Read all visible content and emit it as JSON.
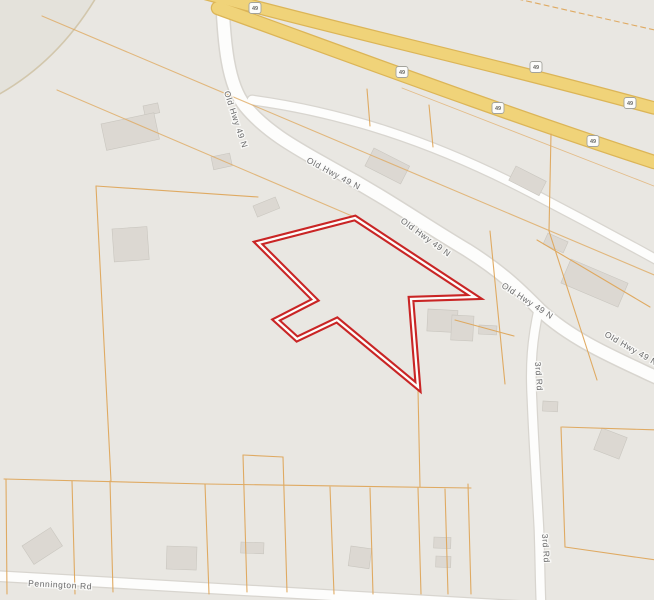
{
  "map": {
    "road_labels": {
      "old_hwy": "Old Hwy 49 N",
      "third_rd": "3rd Rd",
      "pennington": "Pennington Rd"
    },
    "highway": {
      "shield_number": "49"
    },
    "colors": {
      "background": "#e9e7e2",
      "corner_region": "#e4e2db",
      "highway_fill": "#f0d379",
      "highway_casing": "#dcb557",
      "road_fill": "#fdfdfc",
      "road_casing": "#d8d5cf",
      "parcel_line": "#dfa75c",
      "contour_line": "#cfc3a6",
      "building_fill": "#dcd8d2",
      "building_edge": "#c9c6bf",
      "selected_parcel_outline": "#c92525",
      "selected_parcel_gap": "#fdfdfb"
    }
  }
}
